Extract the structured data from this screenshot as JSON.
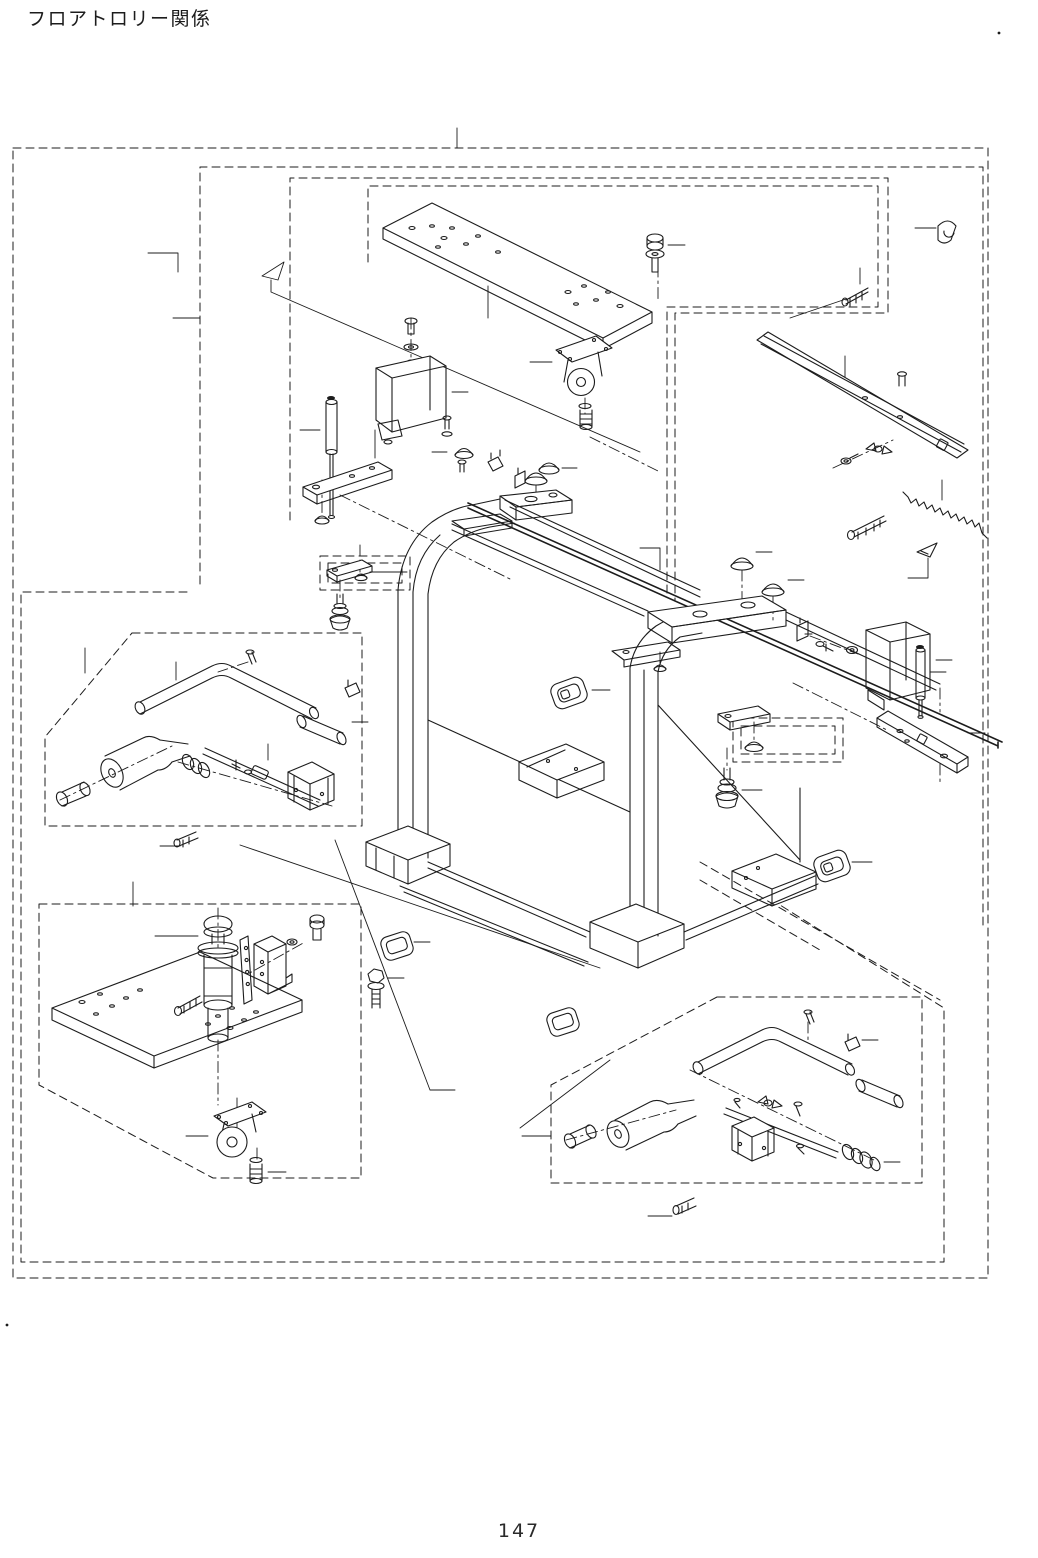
{
  "page": {
    "title": "フロアトロリー関係",
    "page_number": "147"
  },
  "diagram": {
    "kind": "exploded-parts-diagram",
    "callout_text": [],
    "colors": {
      "background": "#ffffff",
      "line": "#1c1c1c"
    }
  }
}
